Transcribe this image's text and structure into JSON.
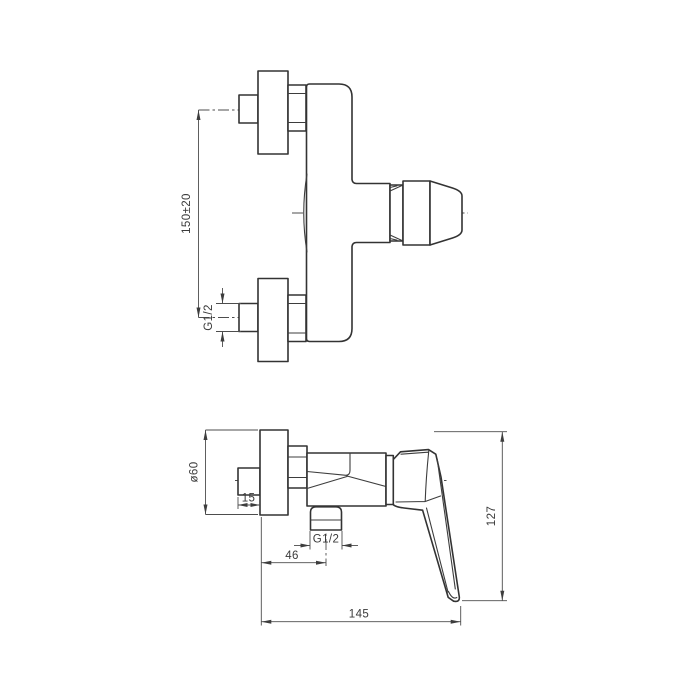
{
  "page": {
    "title": "Wall-mounted shower mixer — installation dimension drawing",
    "background_color": "#ffffff",
    "line_color": "#333333",
    "dimension_line_color": "#4d4d4d",
    "text_color": "#3a3a3a"
  },
  "front_view": {
    "name": "front view",
    "labels": {
      "mount_spacing": "150±20",
      "inlet_thread": "G1/2"
    }
  },
  "side_view": {
    "name": "side view",
    "labels": {
      "flange_diameter": "ø60",
      "wall_offset": "15",
      "outlet_offset": "46",
      "outlet_thread": "G1/2",
      "height": "127",
      "length": "145"
    }
  }
}
